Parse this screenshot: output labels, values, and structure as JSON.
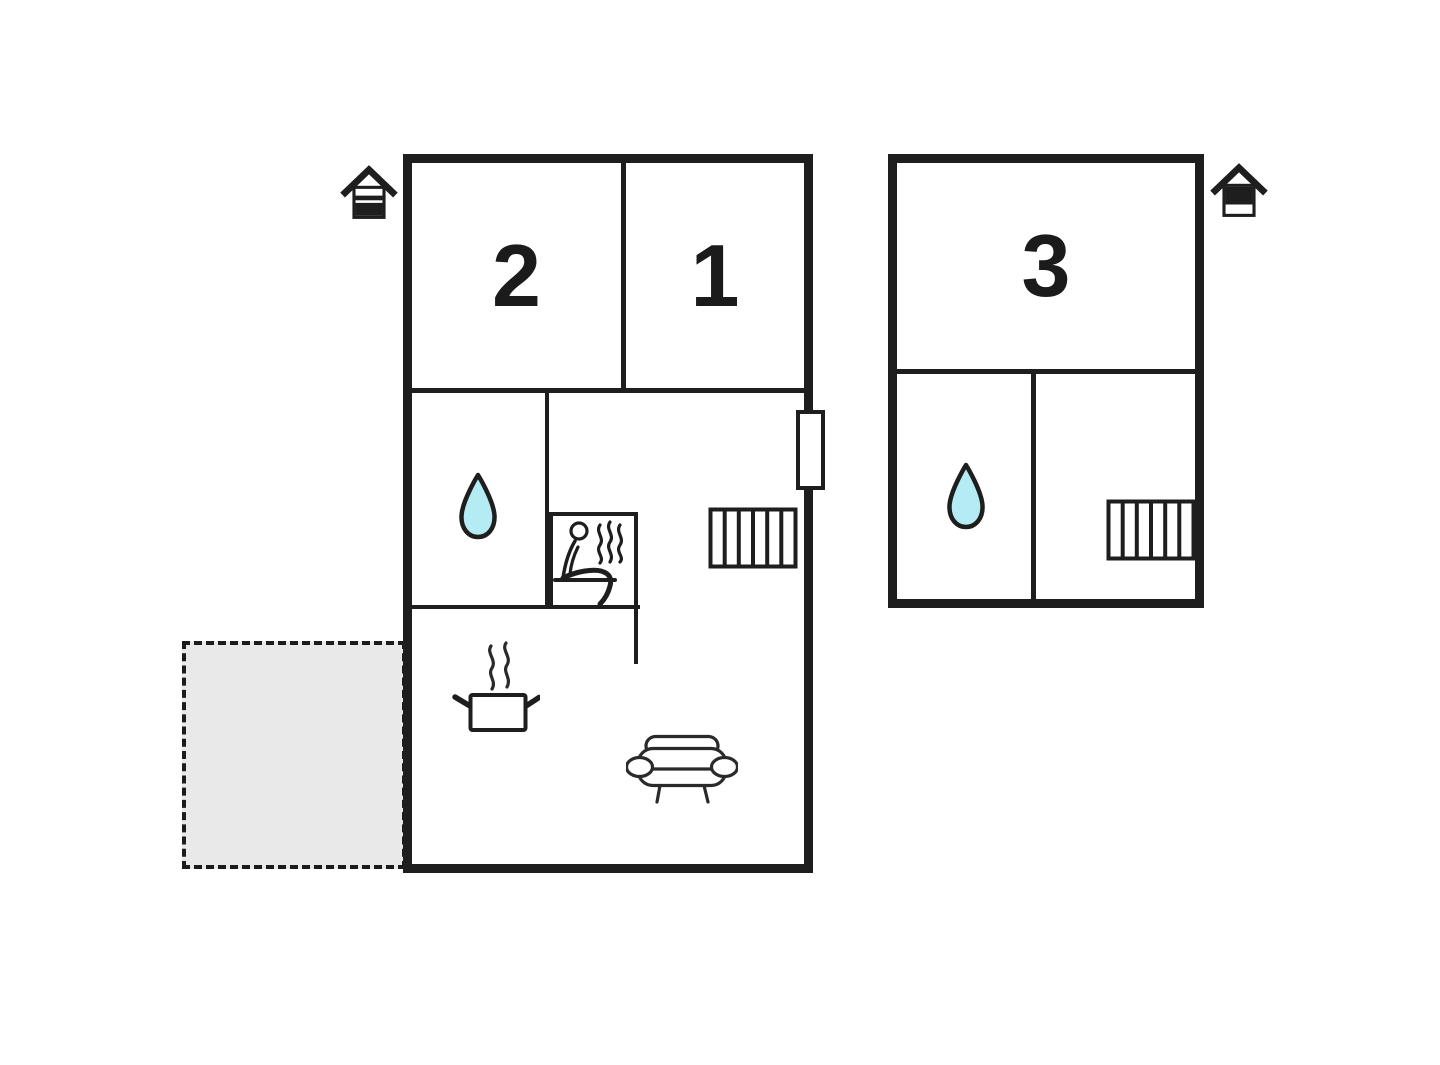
{
  "colors": {
    "wall": "#1e1e1e",
    "background": "#ffffff",
    "terrace_fill": "#e9e9e9",
    "water_drop_fill": "#b5ecf4"
  },
  "buildings": {
    "main": {
      "rooms": {
        "bedroom2": {
          "label": "2"
        },
        "bedroom1": {
          "label": "1"
        }
      },
      "features": [
        "entrance-house-icon",
        "water-drop-icon",
        "sauna-person-icon",
        "steam-icon",
        "radiator-icon",
        "window-marker",
        "cooking-pot-icon",
        "sofa-icon"
      ]
    },
    "annex": {
      "rooms": {
        "room3": {
          "label": "3"
        }
      },
      "features": [
        "entrance-house-icon",
        "water-drop-icon",
        "radiator-icon"
      ]
    },
    "terrace": {
      "features": [
        "dashed-outline"
      ]
    }
  }
}
